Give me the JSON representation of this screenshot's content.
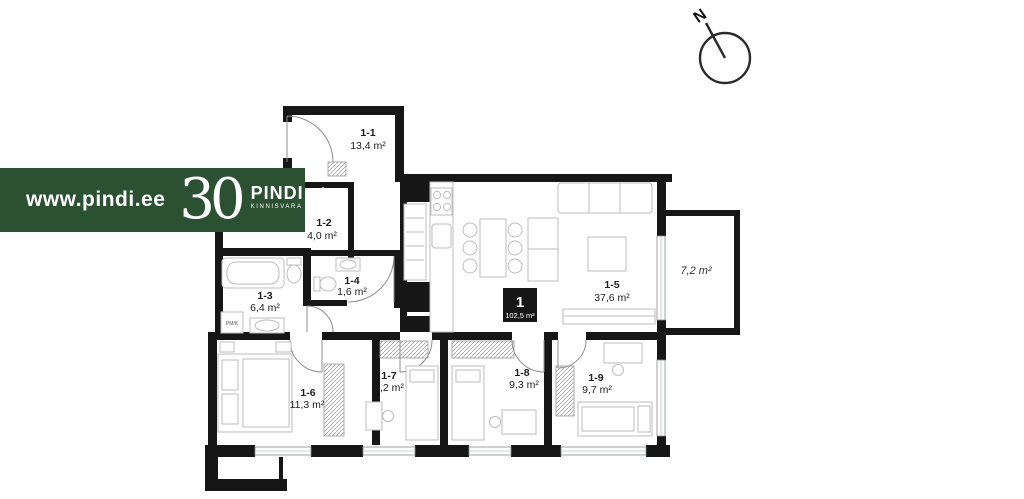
{
  "branding": {
    "website": "www.pindi.ee",
    "anniversary_number": "30",
    "company": "PINDI",
    "company_sub": "KINNISVARA",
    "banner_color": "#2b5032"
  },
  "compass": {
    "north": "N"
  },
  "unit": {
    "number": "1",
    "total_area": "102,5 m²"
  },
  "rooms": [
    {
      "id": "1-1",
      "area": "13,4 m²"
    },
    {
      "id": "1-2",
      "area": "4,0 m²"
    },
    {
      "id": "1-3",
      "area": "6,4 m²"
    },
    {
      "id": "1-4",
      "area": "1,6 m²"
    },
    {
      "id": "1-5",
      "area": "37,6 m²"
    },
    {
      "id": "1-6",
      "area": "11,3 m²"
    },
    {
      "id": "1-7",
      "area": "9,2 m²"
    },
    {
      "id": "1-8",
      "area": "9,3 m²"
    },
    {
      "id": "1-9",
      "area": "9,7 m²"
    }
  ],
  "balcony": {
    "area": "7,2 m²"
  },
  "labels": {
    "washer": "PM/K"
  }
}
